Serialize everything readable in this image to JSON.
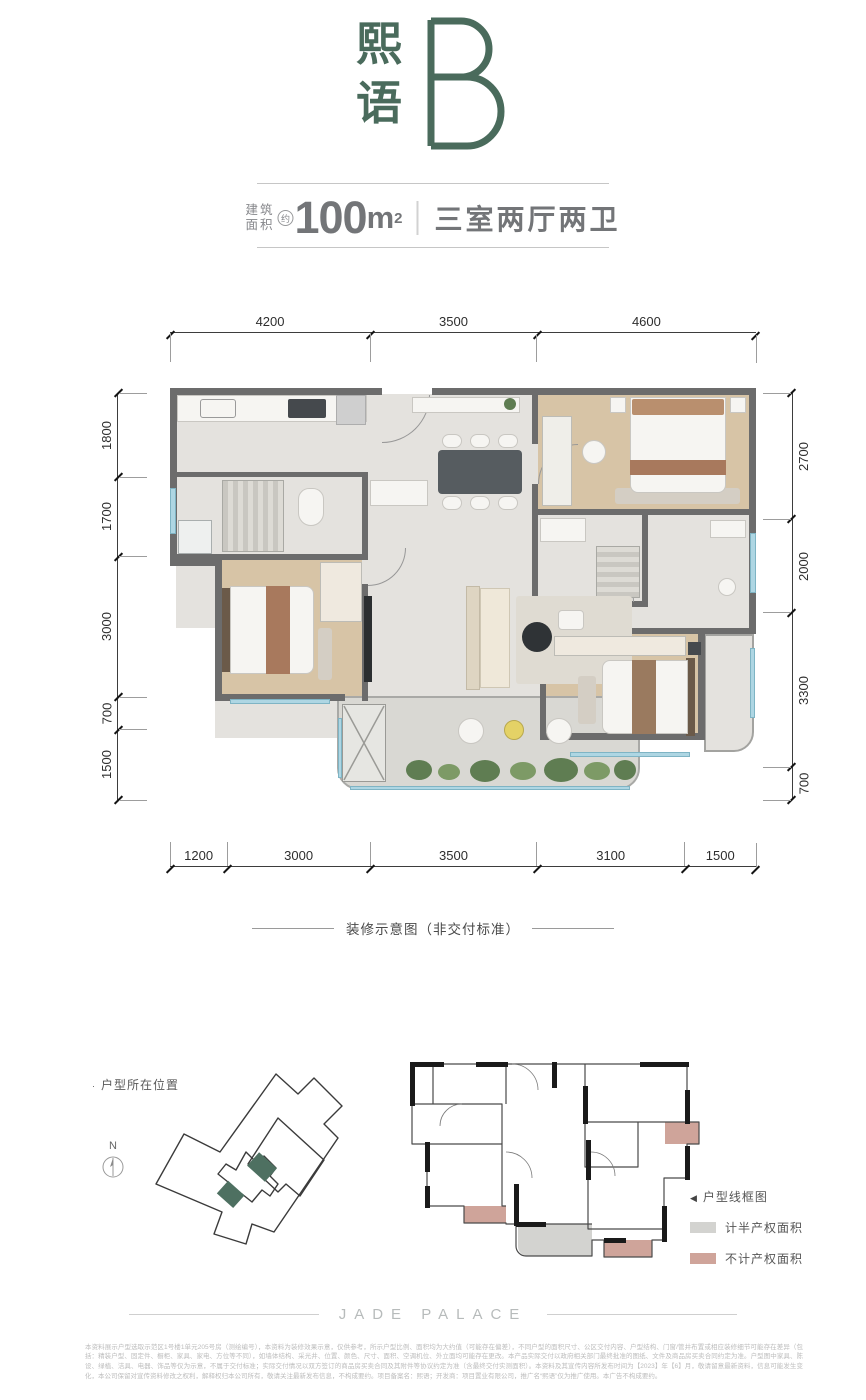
{
  "header": {
    "title_char1": "熙",
    "title_char2": "语",
    "unit_letter": "B",
    "area_label_line1": "建筑",
    "area_label_line2": "面积",
    "area_approx": "约",
    "area_value": "100",
    "area_unit": "m",
    "area_sup": "2",
    "rooms_text": "三室两厅两卫"
  },
  "plan": {
    "caption": "装修示意图（非交付标准）",
    "dims_top": [
      "4200",
      "3500",
      "4600"
    ],
    "dims_bottom": [
      "1200",
      "3000",
      "3500",
      "3100",
      "1500"
    ],
    "dims_left": [
      "1800",
      "1700",
      "3000",
      "700",
      "1500"
    ],
    "dims_right": [
      "2700",
      "2000",
      "3300",
      "700"
    ]
  },
  "footer": {
    "location_marker": "·",
    "location_label": "户型所在位置",
    "north_label": "N",
    "wireframe_marker": "◀",
    "wireframe_label": "户型线框图",
    "legend_half_label": "计半产权面积",
    "legend_excluded_label": "不计产权面积",
    "brand": "JADE PALACE",
    "disclaimer": "本资料展示户型选取示范区1号楼1单元205号房（测绘编号），本资料为装修效果示意，仅供参考，所示户型比例、面积均为大约值（可能存在偏差），不同户型的面积尺寸、公区交付内容、户型结构、门窗/管井布置或相应装修细节可能存在差异（包括：精装户型、固定件、橱柜、家具、家电、方位等不同），如墙体结构、采光井、位置、颜色、尺寸、面积、空调机位、外立面均可能存在更改。本产品实际交付以政府相关部门最终批准的图纸、文件及商品房买卖合同约定为准。户型图中家具、陈设、绿植、洁具、电器、饰品等仅为示意，不属于交付标准；实际交付情况以双方签订的商品房买卖合同及其附件等协议约定为准（含最终交付实测面积）。本资料及其宣传内容所发布时间为【2023】年【6】月，敬请留意最新资料，信息可能发生变化，本公司保留对宣传资料修改之权利，解释权归本公司所有，敬请关注最新发布信息，不构成要约。项目备案名：熙语；开发商：项目置业有限公司，推广名“熙语”仅为推广使用。本广告不构成要约。"
  },
  "colors": {
    "accent": "#4a6b5c",
    "text_gray": "#737578",
    "legend_half": "#d3d3d0",
    "legend_excluded": "#cfa49a",
    "wall": "#6c6c6c",
    "window_blue": "#aed6e3"
  }
}
